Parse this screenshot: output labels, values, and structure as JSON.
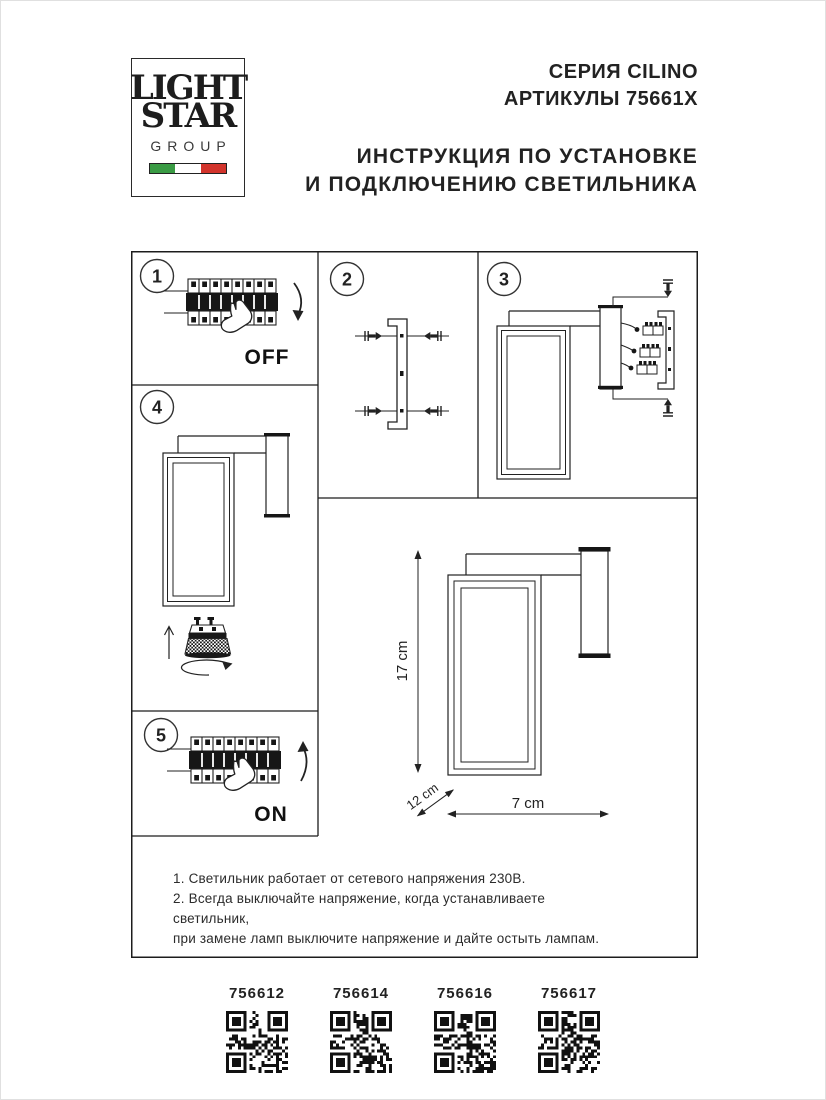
{
  "header": {
    "logo": {
      "line1": "LIGHT",
      "line2": "STAR",
      "line3": "GROUP"
    },
    "series": "СЕРИЯ CILINO",
    "articles": "АРТИКУЛЫ 75661X",
    "title_line1": "ИНСТРУКЦИЯ ПО УСТАНОВКЕ",
    "title_line2": "И ПОДКЛЮЧЕНИЮ СВЕТИЛЬНИКА"
  },
  "colors": {
    "flag_green": "#3a9b44",
    "flag_white": "#ffffff",
    "flag_red": "#d2342c",
    "line_art": "#222222"
  },
  "steps": [
    {
      "number": "1",
      "label": "OFF"
    },
    {
      "number": "2",
      "label": ""
    },
    {
      "number": "3",
      "label": ""
    },
    {
      "number": "4",
      "label": ""
    },
    {
      "number": "5",
      "label": "ON"
    }
  ],
  "dimensions": {
    "height": "17 cm",
    "depth": "12 cm",
    "width": "7 cm"
  },
  "notes": [
    "1. Светильник работает от сетевого напряжения 230В.",
    "2. Всегда выключайте напряжение, когда устанавливаете светильник,",
    "при замене ламп выключите напряжение и дайте остыть лампам."
  ],
  "products": [
    {
      "article": "756612"
    },
    {
      "article": "756614"
    },
    {
      "article": "756616"
    },
    {
      "article": "756617"
    }
  ]
}
